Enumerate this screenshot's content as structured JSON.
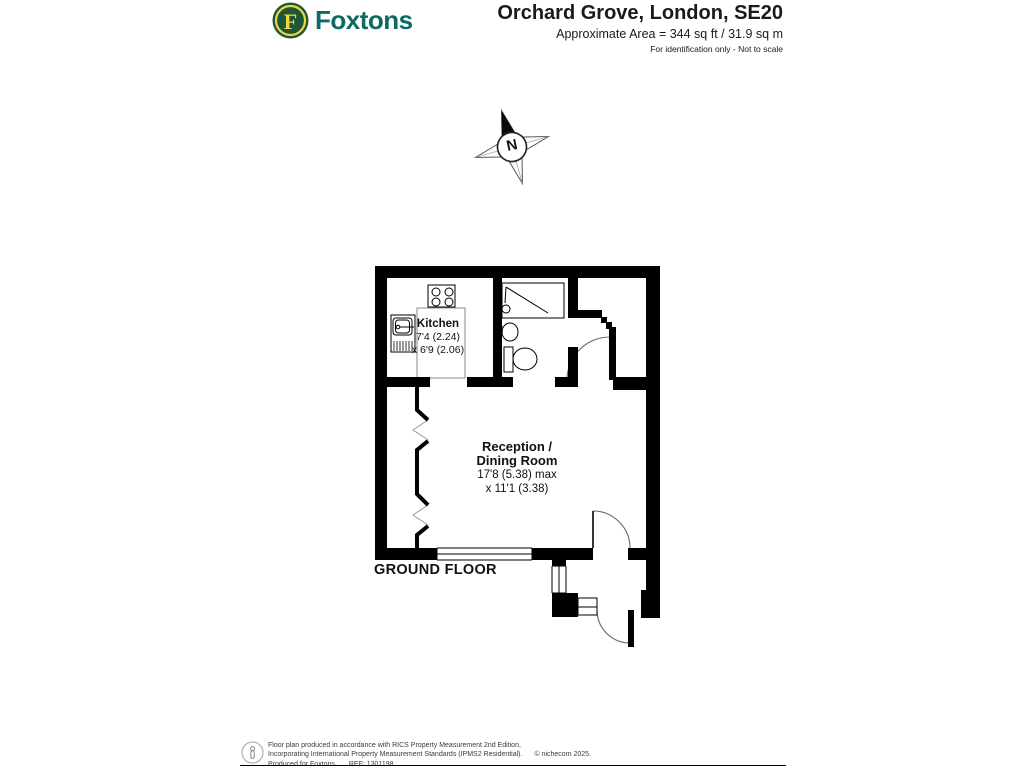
{
  "header": {
    "logo": {
      "monogram": "F",
      "brand": "Foxtons"
    },
    "title": "Orchard Grove, London, SE20",
    "area": "Approximate Area = 344 sq ft / 31.9 sq m",
    "note": "For identification only - Not to scale"
  },
  "compass": {
    "north": "N"
  },
  "plan": {
    "floor": "GROUND FLOOR",
    "kitchen": {
      "name": "Kitchen",
      "dims": [
        "7'4 (2.24)",
        "x 6'9 (2.06)"
      ]
    },
    "reception": {
      "name": [
        "Reception /",
        "Dining Room"
      ],
      "dims": [
        "17'8 (5.38) max",
        "x 11'1 (3.38)"
      ]
    }
  },
  "footer": {
    "line1": "Floor plan produced in accordance with RICS Property Measurement 2nd Edition,",
    "line2": "Incorporating International Property Measurement Standards (IPMS2 Residential).",
    "copyright": "© nichecom 2025.",
    "produced": "Produced for Foxtons.",
    "ref": "REF: 1301198"
  },
  "colors": {
    "brand_teal": "#0E6B63",
    "logo_green": "#1E5638",
    "logo_yellow": "#F2D43C"
  }
}
